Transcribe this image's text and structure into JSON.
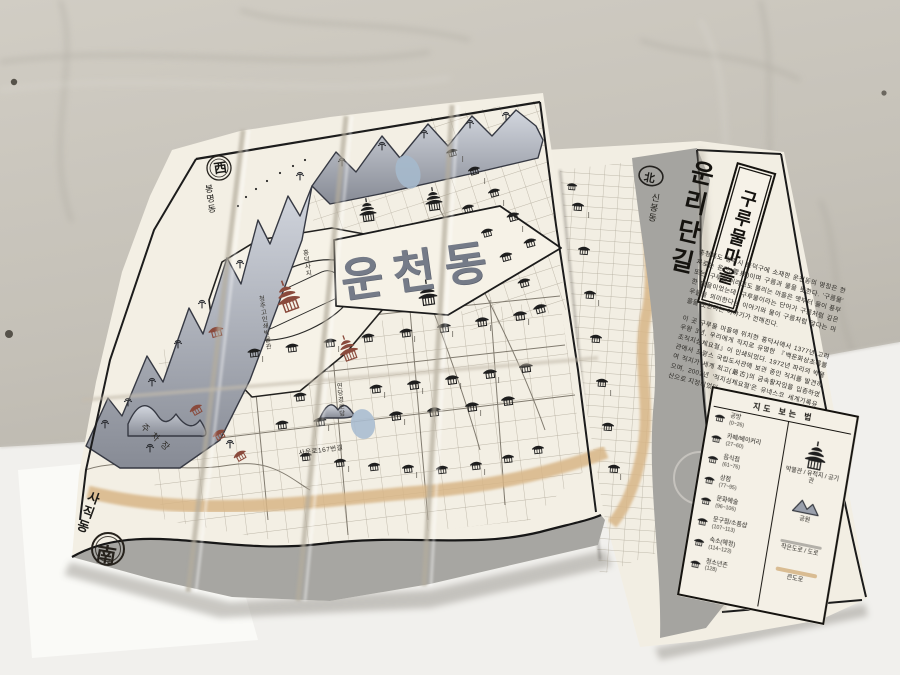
{
  "map": {
    "title": "운천동",
    "compass": {
      "west": {
        "char": "西",
        "label": "봉명동"
      },
      "north": {
        "char": "北",
        "label": "신봉동"
      },
      "south": {
        "char": "南",
        "label": "사직동"
      },
      "east": {
        "char": "東",
        "label": "무심천"
      }
    },
    "labels": {
      "temple_site": "흥덕사지",
      "print_museum": "청주고인쇄박물관",
      "parking": "주차장",
      "senior_center": "연당경로당",
      "street_167": "사운로167번길"
    }
  },
  "cover": {
    "road_title": "운리단길",
    "village_title": "구루물마을",
    "paragraph_intro": "충청북도 청주시 흥덕구에 소재한 운천동의 명칭은 한자로는 운천(雲泉)이며 구름과 물을 뜻한다. '구름물' 또는 '구루물'이라고도 불리는 마을은 옛부터 물이 풍부한 마을이었는데, 구루물이라는 단어가 구름처럼 깊은 우물을 의미한다는 이야기와 물이 구름처럼 많다는 마을을 뜻한다는 이야기가 전해진다.",
    "paragraph_jikji": "이 곳 구루물 마을에 위치한 흥덕사에서 1377년 고려 우왕 3년, 우리에게 직지로 유명한 『백운화상초록불조직지심체요절』이 인쇄되었다. 1972년 파리의 박물관에서 프랑스 국립도서관에 보관 중인 직지를 발견하여 직지가 세계 최고(最古)의 금속활자임을 입증하였으며, 2001년 '직지심체요절'은 유네스코 세계기록유산으로 지정되었다."
  },
  "legend": {
    "title": "지도 보는 법",
    "items": [
      {
        "label": "공방",
        "range": "(0~26)"
      },
      {
        "label": "카페/베이커리",
        "range": "(27~60)"
      },
      {
        "label": "음식점",
        "range": "(61~76)"
      },
      {
        "label": "상점",
        "range": "(77~95)"
      },
      {
        "label": "문화예술",
        "range": "(96~106)"
      },
      {
        "label": "문구점/소품샵",
        "range": "(107~113)"
      },
      {
        "label": "숙소(예정)",
        "range": "(114~123)"
      },
      {
        "label": "청소년존",
        "range": "(128)"
      }
    ],
    "symbols": [
      {
        "label": "박물관 / 유적지 / 공기관"
      },
      {
        "label": "공원"
      },
      {
        "label": "작은도로 / 도로"
      },
      {
        "label": "큰도로"
      }
    ]
  },
  "colors": {
    "paper": "#f3efe4",
    "ink": "#1e1e1e",
    "road_large": "#d8b687",
    "road_small": "#b3b0a9",
    "river_gray": "#a5a4a0",
    "park_blue": "#a5b9cc",
    "landmark_red": "#8a4a3c"
  }
}
